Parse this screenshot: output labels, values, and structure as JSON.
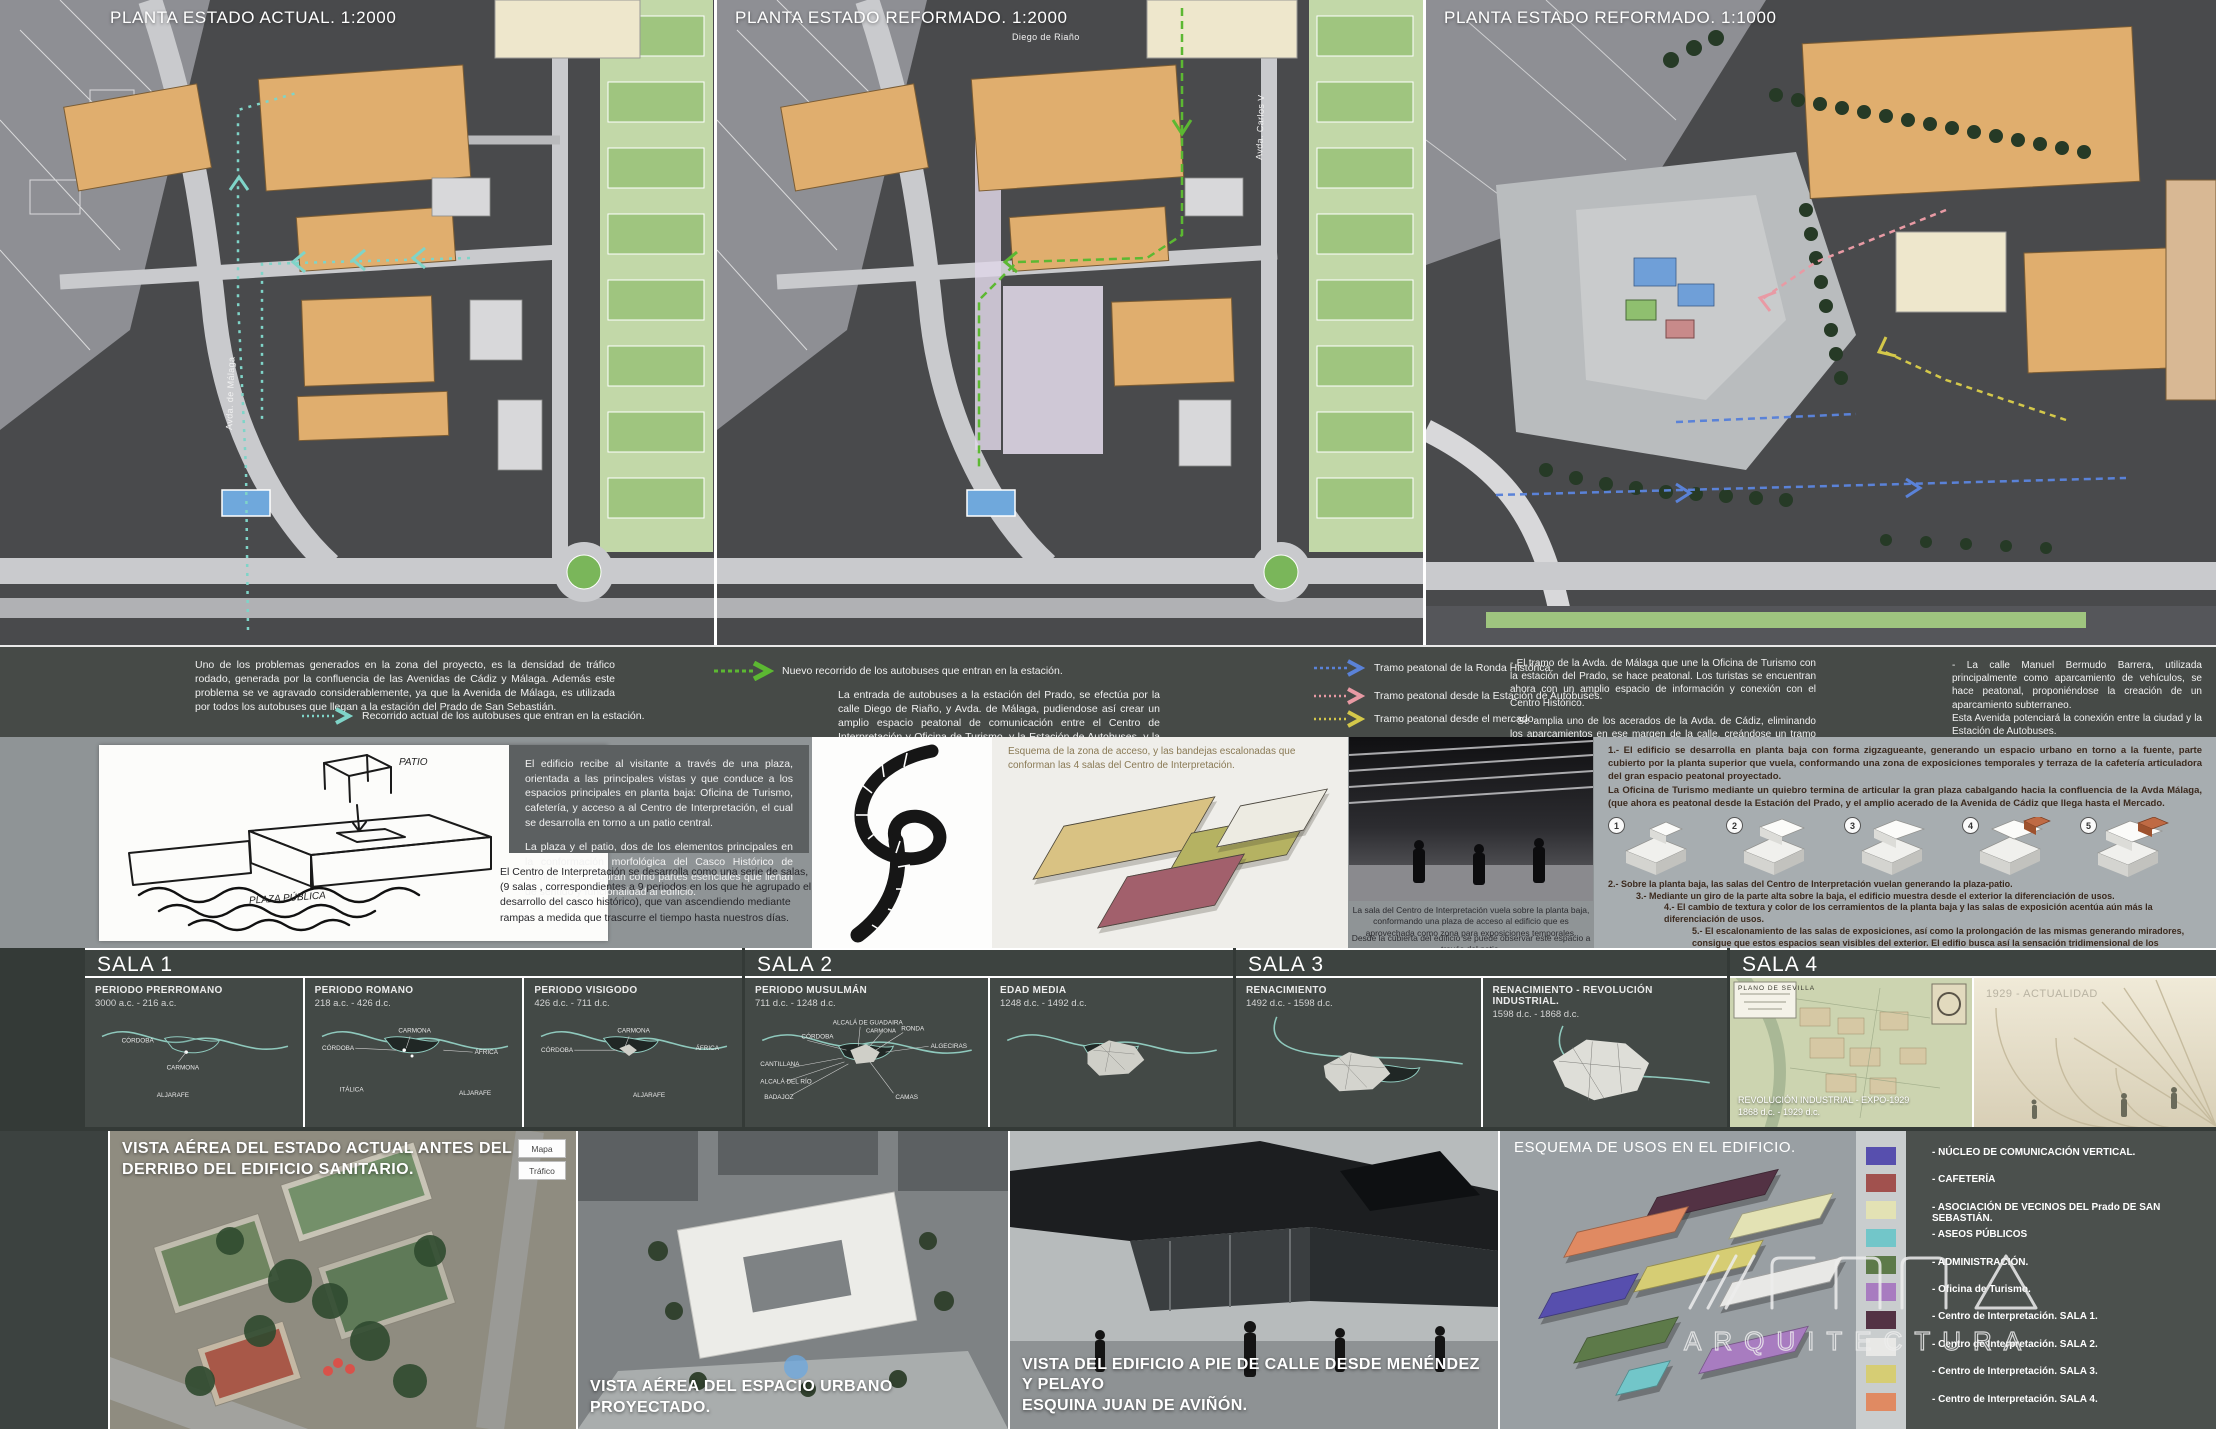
{
  "plans": {
    "p1": {
      "title": "PLANTA ESTADO ACTUAL. 1:2000",
      "street1": "Avda. de Málaga"
    },
    "p2": {
      "title": "PLANTA ESTADO REFORMADO. 1:2000",
      "street1": "Diego de Riaño",
      "street2": "Avda. Carlos V"
    },
    "p3": {
      "title": "PLANTA ESTADO REFORMADO. 1:1000"
    }
  },
  "colors": {
    "route_current": "#7fd4c8",
    "route_new": "#5cb832",
    "tramo_ronda": "#5a82d8",
    "tramo_estacion": "#e89aa4",
    "tramo_mercado": "#d4c84a"
  },
  "legend": {
    "intro": "Uno de los problemas generados  en la zona del proyecto, es la densidad de tráfico rodado, generada por la confluencia de las Avenidas de Cádiz y Málaga. Además este problema se ve agravado considerablemente, ya que la Avenida de Málaga, es utilizada por todos los autobuses que llegan a la estación del Prado de San Sebastián.",
    "current_route": "Recorrido actual de los autobuses que entran en la estación.",
    "new_route": "Nuevo recorrido de los autobuses que entran en la estación.",
    "entry_text": "La entrada de autobuses a la estación del Prado, se efectúa por la calle Diego de Riaño, y Avda. de Málaga, pudiendose así crear un amplio espacio peatonal de comunicación entre el Centro de Interpretación y Oficina de Turismo, y la Estación de Autobuses, y la antigua Estación de Cádiz.",
    "tramo1": "Tramo peatonal de la Ronda Histórica.",
    "tramo2": "Tramo peatonal desde la Estación de Autobuses.",
    "tramo3": "Tramo peatonal desde el mercado.",
    "bullet1": "- El tramo de la Avda. de Málaga que une la Oficina de Turismo con la estación del Prado, se hace peatonal. Los turistas se encuentran ahora con un amplio espacio de información y conexión con el Centro Histórico.",
    "bullet2": "- Se amplia uno de los acerados de la Avda. de Cádiz, eliminando los aparcamientos en ese margen de la calle, creándose un tramo peatonal de entidad entre ambas zonas.",
    "bullet3": "- Junto a la fuente, una serie de pérgolas con bancos sobre la cubierta del aparcamiento, jardinera-banco arboladas, estacionamiento de bicis, y la zona de exposiciones temporales, terminan de articular el espacio.",
    "right1": "- La calle Manuel Bermudo Barrera, utilizada principalmente como aparcamiento de vehículos, se hace peatonal, proponiéndose la creación de un aparcamiento subterraneo.",
    "right2": "Esta Avenida potenciará la conexión entre la ciudad y la Estación de Autobuses."
  },
  "concept": {
    "sketch_note_top": "PATIO",
    "sketch_note_bottom": "PLAZA PÚBLICA",
    "para1": "El edificio recibe al visitante a través de una plaza, orientada a las principales vistas y que conduce a los espacios principales en planta baja: Oficina de Turismo, cafetería, y acceso a al Centro de Interpretación, el cual se desarrolla en torno a un patio central.",
    "para2": "La plaza y el patio, dos de los elementos principales en la conformación morfológica del Casco Histórico de Sevilla, se configuran como partes esenciales que llenan de sentido y funcionalidad al edificio.",
    "para3": "El Centro de Interpretación se desarrolla como una serie de salas, (9 salas , correspondientes a 9 periodos en los que he agrupado el desarrollo del casco histórico), que van ascendiendo mediante rampas a medida que trascurre el tiempo hasta nuestros días.",
    "esquema_caption": "Esquema de la zona de acceso, y las bandejas escalonadas que conforman las 4 salas del Centro de Interpretación.",
    "tray_colors": {
      "tan": "#d9c283",
      "olive": "#b5b262",
      "maroon": "#a2606c",
      "white": "#edebe2"
    },
    "render_caption1": "La sala del Centro de Interpretación vuela sobre la planta baja, conformando una plaza de acceso al edificio que es aprovechada como zona para exposiciones temporales.",
    "render_caption2": "Desde la cubierta del edificio se puede observar este espacio a través del patio.",
    "note1a": "1.- El edificio se desarrolla en planta baja con forma zigzagueante, generando un espacio urbano en torno a la fuente, parte cubierto por la planta superior que vuela, conformando una zona de exposiciones temporales y terraza de la cafetería articuladora del gran espacio peatonal proyectado.",
    "note1b": "La Oficina de Turismo mediante un quiebro termina de articular la gran plaza cabalgando hacia la confluencia de la Avda Málaga, (que ahora es peatonal desde la Estación del Prado, y el amplio acerado de la Avenida de Cádiz que llega hasta el Mercado.",
    "steps": {
      "s1": "1",
      "s2": "2",
      "s3": "3",
      "s4": "4",
      "s5": "5"
    },
    "note2": "2.- Sobre la planta baja, las salas del Centro de Interpretación vuelan generando la plaza-patio.",
    "note3": "3.- Mediante un giro de la parte alta sobre la baja, el edificio muestra desde el exterior la diferenciación de usos.",
    "note4": "4.- El cambio de textura y color de los cerramientos de la planta baja y las salas de exposición acentúa aún más la diferenciación de usos.",
    "note5": "5.- El escalonamiento de las salas de exposiciones, así como la prolongación de las mismas generando miradores, consigue que estos espacios sean visibles del exterior.  El edifio busca así la sensación tridimensional de los espacios, desde dentro, y desde fuera."
  },
  "salas": {
    "s1": {
      "title": "SALA 1",
      "p1": {
        "name": "PERIODO PRERROMANO",
        "dates": "3000 a.c. - 216 a.c.",
        "l1": "CÓRDOBA",
        "l2": "CARMONA",
        "l3": "ALJARAFE"
      },
      "p2": {
        "name": "PERIODO ROMANO",
        "dates": "218 a.c. - 426 d.c.",
        "l1": "CÓRDOBA",
        "l2": "CARMONA",
        "l3": "ÁFRICA",
        "l4": "ITÁLICA",
        "l5": "ALJARAFE"
      },
      "p3": {
        "name": "PERIODO VISIGODO",
        "dates": "426 d.c. - 711 d.c.",
        "l1": "CÓRDOBA",
        "l2": "CARMONA",
        "l3": "ÁFRICA",
        "l4": "ALJARAFE"
      }
    },
    "s2": {
      "title": "SALA 2",
      "p1": {
        "name": "PERIODO MUSULMÁN",
        "dates": "711 d.c. - 1248 d.c.",
        "l1": "CANTILLANA",
        "l2": "CÓRDOBA",
        "l3": "ALCALÁ DE GUADAIRA",
        "l4": "CARMONA",
        "l5": "RONDA",
        "l6": "ALGECIRAS",
        "l7": "ALCALÁ DEL RÍO",
        "l8": "BADAJOZ",
        "l9": "CAMAS"
      },
      "p2": {
        "name": "EDAD MEDIA",
        "dates": "1248 d.c. - 1492 d.c."
      }
    },
    "s3": {
      "title": "SALA 3",
      "p1": {
        "name": "RENACIMIENTO",
        "dates": "1492 d.c. - 1598 d.c."
      },
      "p2": {
        "name": "RENACIMIENTO - REVOLUCIÓN INDUSTRIAL.",
        "dates": "1598 d.c. - 1868 d.c."
      }
    },
    "s4": {
      "title": "SALA 4",
      "p1": {
        "name": "REVOLUCIÓN INDUSTRIAL - EXPO-1929",
        "dates": "1868 d.c. - 1929 d.c.",
        "map_title": "PLANO DE SEVILLA"
      },
      "p2": {
        "name": "1929 - ACTUALIDAD"
      }
    }
  },
  "bottom": {
    "aerial_caption": "VISTA AÉREA DEL ESTADO ACTUAL ANTES DEL DERRIBO DEL EDIFICIO SANITARIO.",
    "map_btn1": "Mapa",
    "map_btn2": "Tráfico",
    "render1_caption": "VISTA AÉREA DEL ESPACIO URBANO PROYECTADO.",
    "render2_caption1": "VISTA DEL EDIFICIO A PIE DE CALLE DESDE MENÉNDEZ Y PELAYO",
    "render2_caption2": "ESQUINA JUAN DE AVIÑÓN.",
    "usos_title": "ESQUEMA DE USOS EN EL EDIFICIO.",
    "legend_items": {
      "i1": {
        "label": "- NÚCLEO DE COMUNICACIÓN VERTICAL.",
        "color": "#574fae"
      },
      "i2": {
        "label": "- CAFETERÍA",
        "color": "#a1514e"
      },
      "i3": {
        "label": "- ASOCIACIÓN DE VECINOS DEL Prado DE SAN SEBASTIÁN.",
        "color": "#e3e2b4"
      },
      "i4": {
        "label": "- ASEOS PÚBLICOS",
        "color": "#72c6c9"
      },
      "i5": {
        "label": "- ADMINISTRACIÓN.",
        "color": "#5d7a49"
      },
      "i6": {
        "label": "- Oficina de Turismo.",
        "color": "#a87cc0"
      },
      "i7": {
        "label": "- Centro de Interpretación. SALA 1.",
        "color": "#533244"
      },
      "i8": {
        "label": "- Centro de Interpretación. SALA 2.",
        "color": "#e8e8e6"
      },
      "i9": {
        "label": "- Centro de Interpretación. SALA 3.",
        "color": "#d6cd74"
      },
      "i10": {
        "label": "- Centro de Interpretación. SALA 4.",
        "color": "#e08a62"
      }
    },
    "logo_line2": "ARQUITECTURA"
  }
}
